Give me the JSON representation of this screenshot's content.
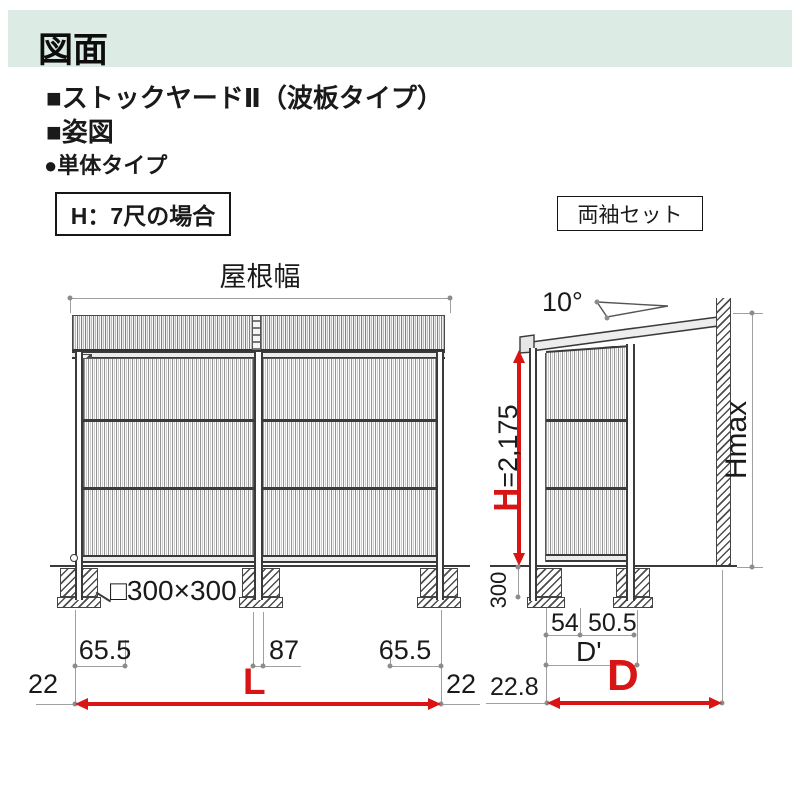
{
  "page": {
    "header_title": "図面"
  },
  "headings": {
    "product": "■ストックヤードⅡ（波板タイプ）",
    "view": "■姿図",
    "unit_type": "●単体タイプ",
    "height_case": "H：7尺の場合",
    "sleeve_set": "両袖セット"
  },
  "front_view": {
    "roof_width_label": "屋根幅",
    "foundation_size": "□300×300",
    "dims": {
      "left_post_offset": "65.5",
      "center_post": "87",
      "right_post_offset": "65.5",
      "left_edge": "22",
      "right_edge": "22",
      "total_width": "L"
    }
  },
  "side_view": {
    "roof_angle": "10°",
    "height_label": "H",
    "height_value": "=2,175",
    "embed_depth": "300",
    "max_height": "Hmax",
    "dims": {
      "front_post": "54",
      "rear_offset": "50.5",
      "inner_depth": "D'",
      "front_edge": "22.8",
      "total_depth": "D"
    }
  },
  "colors": {
    "accent_red": "#d81414",
    "header_bg": "#dcece4",
    "line_dark": "#3a3a3a",
    "dim_gray": "#a0a0a0"
  }
}
